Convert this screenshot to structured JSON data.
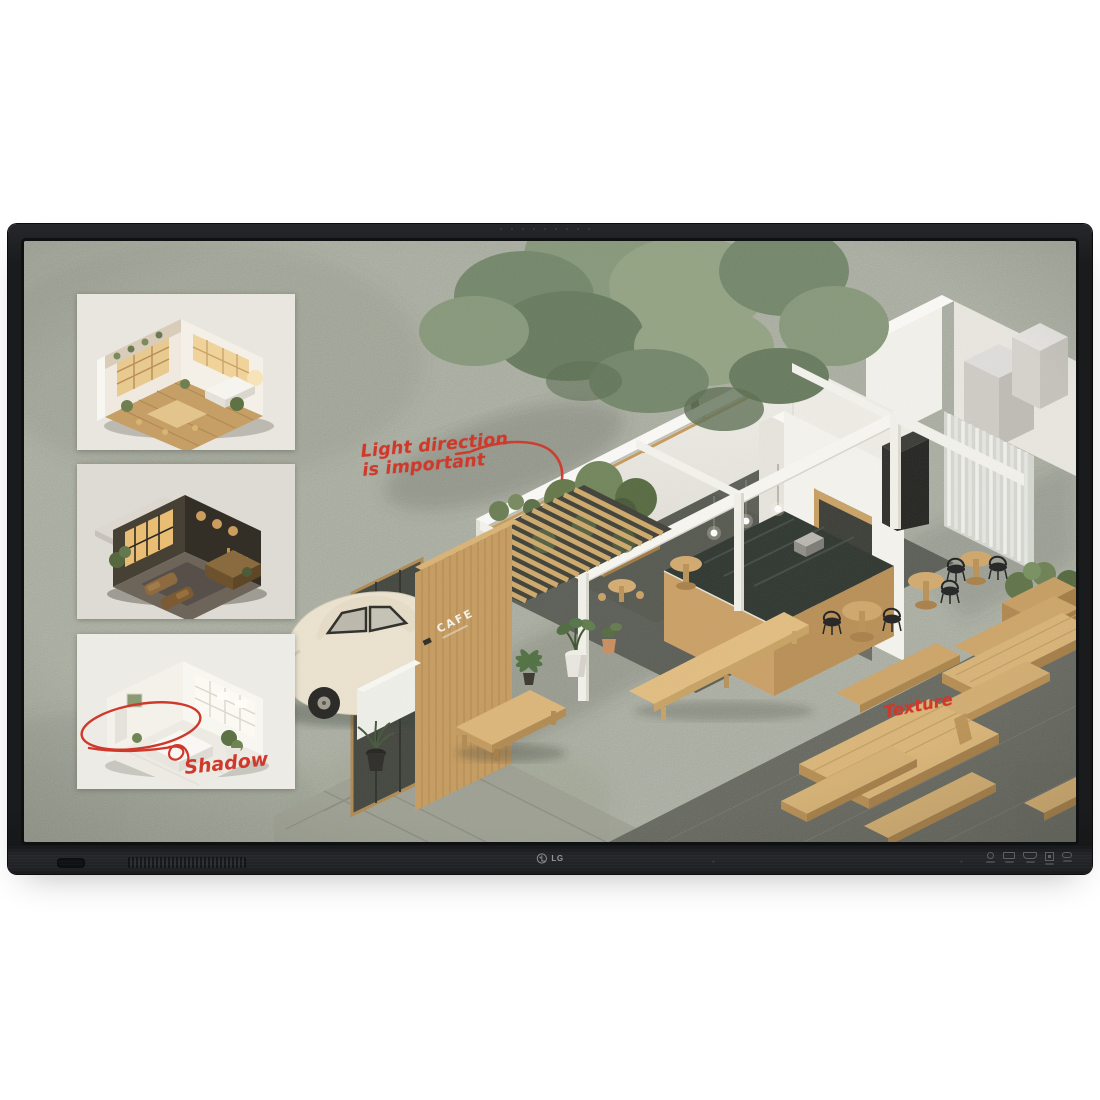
{
  "device": {
    "brand": "LG",
    "frame_color": "#1b1c1e",
    "chin_color": "#232427"
  },
  "screen": {
    "concrete_color": "#a9ad9f",
    "ink_color": "#cf392b",
    "wood_color": "#d2a96e",
    "annotations": {
      "light_line1": "Light direction",
      "light_line2": "is important",
      "shadow": "Shadow",
      "texture": "Texture"
    },
    "cafe_sign": "CAFE",
    "thumbnails": [
      {
        "name": "thumbnail-warm-cafe-interior"
      },
      {
        "name": "thumbnail-dark-lounge-interior"
      },
      {
        "name": "thumbnail-bright-studio-interior"
      }
    ]
  }
}
